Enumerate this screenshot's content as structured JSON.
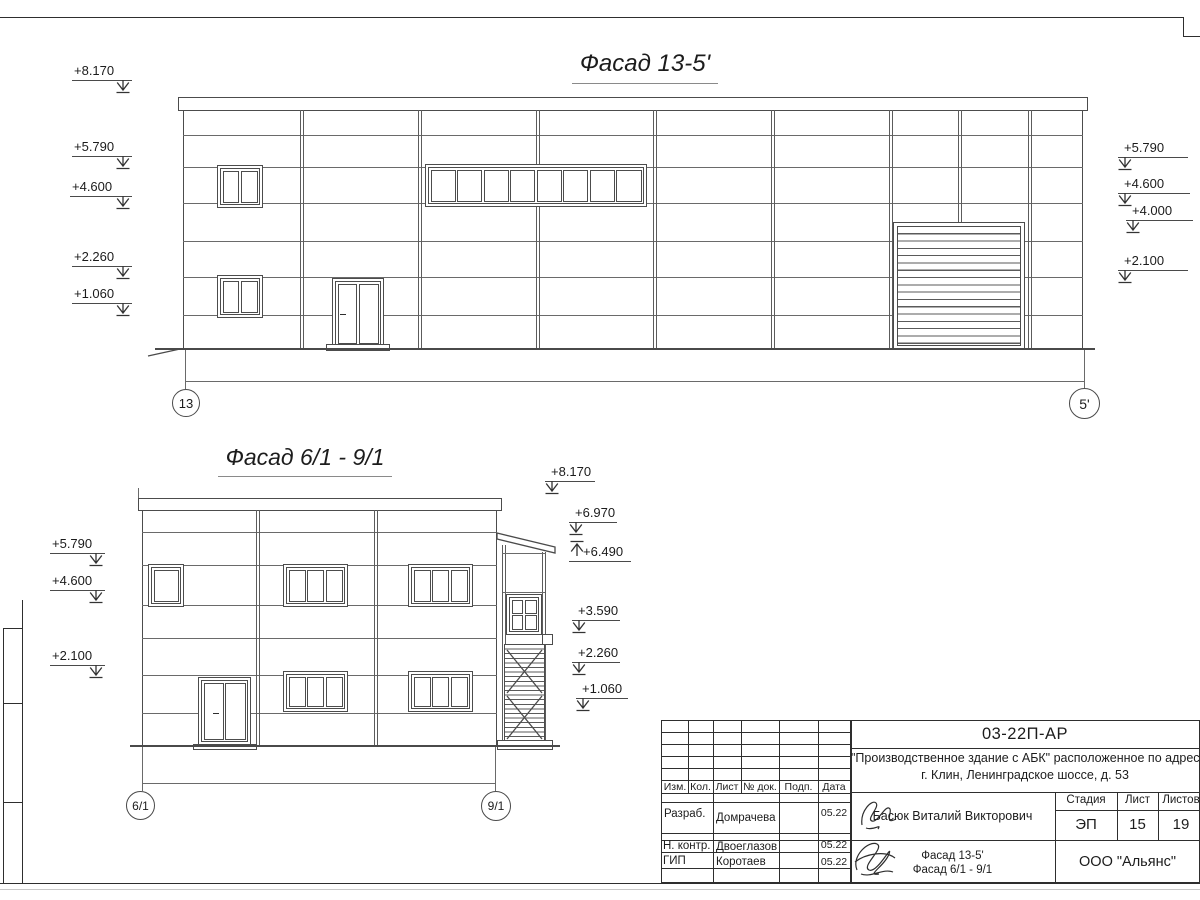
{
  "facade1": {
    "title": "Фасад 13-5'",
    "marks_left": [
      "+8.170",
      "+5.790",
      "+4.600",
      "+2.260",
      "+1.060"
    ],
    "marks_right": [
      "+5.790",
      "+4.600",
      "+4.000",
      "+2.100"
    ],
    "axis_left": "13",
    "axis_right": "5'"
  },
  "facade2": {
    "title": "Фасад 6/1 - 9/1",
    "marks_left": [
      "+5.790",
      "+4.600",
      "+2.100"
    ],
    "marks_right": [
      "+8.170",
      "+6.970",
      "+6.490",
      "+3.590",
      "+2.260",
      "+1.060"
    ],
    "axis_left": "6/1",
    "axis_right": "9/1"
  },
  "title_block": {
    "doc_number": "03-22П-АР",
    "project_line1": "\"Производственное здание с АБК\" расположенное по адресу:",
    "project_line2": "г. Клин, Ленинградское шоссе, д. 53",
    "columns": [
      "Изм.",
      "Кол.",
      "Лист",
      "№ док.",
      "Подп.",
      "Дата"
    ],
    "roles": [
      {
        "role": "Разраб.",
        "name": "Домрачева",
        "date": "05.22"
      },
      {
        "role": "Н. контр.",
        "name": "Двоеглазов",
        "date": "05.22"
      },
      {
        "role": "ГИП",
        "name": "Коротаев",
        "date": "05.22"
      }
    ],
    "author": "Басюк Виталий Викторович",
    "stage_label": "Стадия",
    "sheet_label": "Лист",
    "sheets_label": "Листов",
    "stage": "ЭП",
    "sheet": "15",
    "sheets": "19",
    "drawing_title_line1": "Фасад 13-5'",
    "drawing_title_line2": "Фасад 6/1 - 9/1",
    "company": "ООО \"Альянс\""
  }
}
